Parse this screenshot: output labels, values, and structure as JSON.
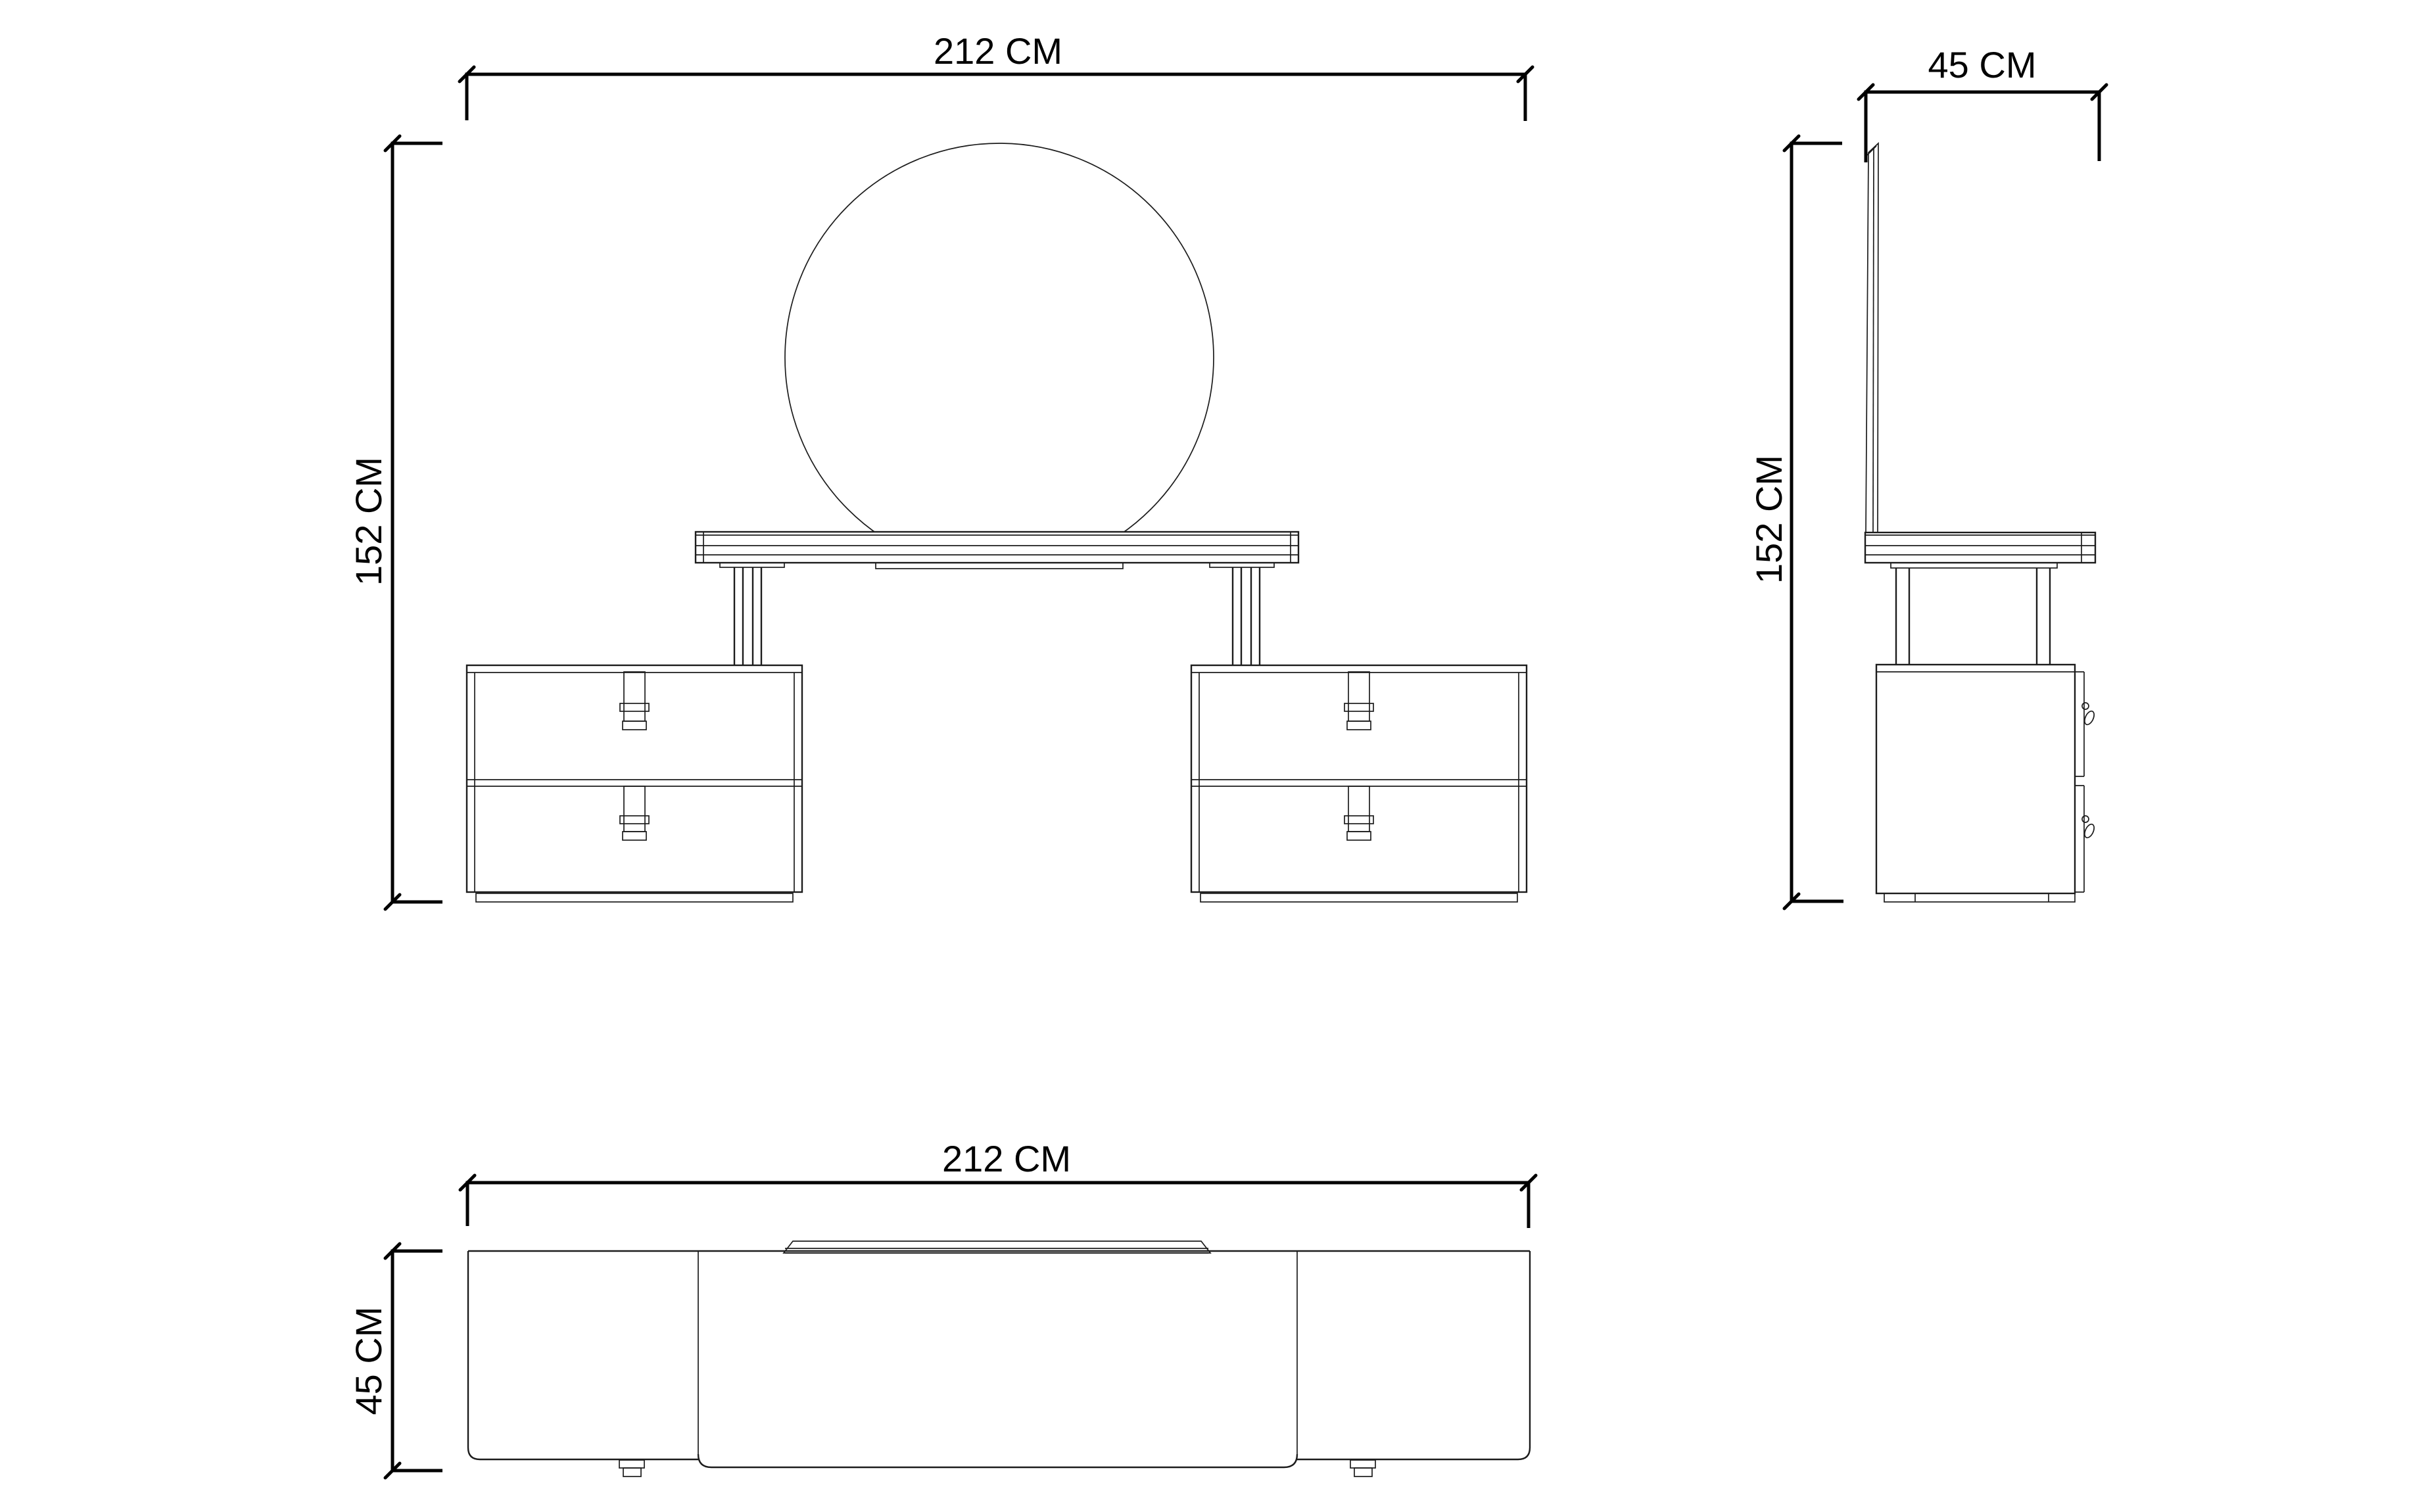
{
  "document": {
    "type": "furniture-technical-drawing",
    "units": "CM",
    "background": "#ffffff"
  },
  "colors": {
    "drawing_line": "#1c1c1c",
    "dimension_line": "#000000",
    "text": "#000000"
  },
  "views": {
    "front": {
      "title": "front-elevation",
      "width_label": "212 CM",
      "height_label": "152 CM"
    },
    "side": {
      "title": "side-elevation",
      "depth_label": "45 CM",
      "height_label": "152 CM"
    },
    "top": {
      "title": "plan-view",
      "width_label": "212 CM",
      "depth_label": "45 CM"
    }
  }
}
